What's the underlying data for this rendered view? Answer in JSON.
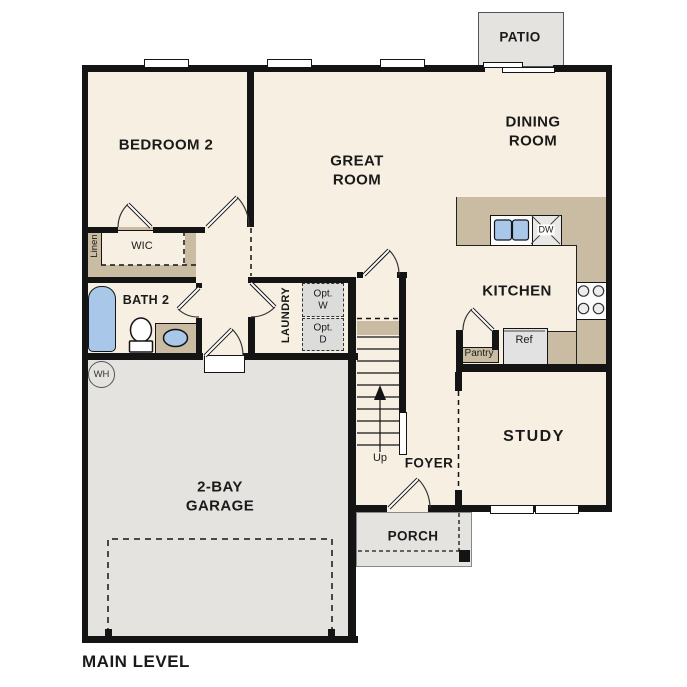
{
  "plan": {
    "title": "MAIN LEVEL",
    "rooms": {
      "bedroom2": "BEDROOM 2",
      "great_room": "GREAT\nROOM",
      "dining_room": "DINING\nROOM",
      "kitchen": "KITCHEN",
      "study": "STUDY",
      "foyer": "FOYER",
      "garage": "2-BAY\nGARAGE",
      "bath2": "BATH 2",
      "laundry": "LAUNDRY",
      "wic": "WIC",
      "porch": "PORCH",
      "patio": "PATIO"
    },
    "fixtures": {
      "linen": "Linen",
      "opt_washer": "Opt.\nW",
      "opt_dryer": "Opt.\nD",
      "pantry": "Pantry",
      "ref": "Ref",
      "dishwasher": "DW",
      "water_heater": "WH",
      "stairs_up": "Up"
    },
    "colors": {
      "floor": "#f6efe2",
      "wall": "#141414",
      "counter_tan": "#c9bca3",
      "exterior_gray": "#e4e3e0",
      "fixture_blue": "#a9c8e9",
      "appliance_gray": "#e2e2e2"
    }
  }
}
